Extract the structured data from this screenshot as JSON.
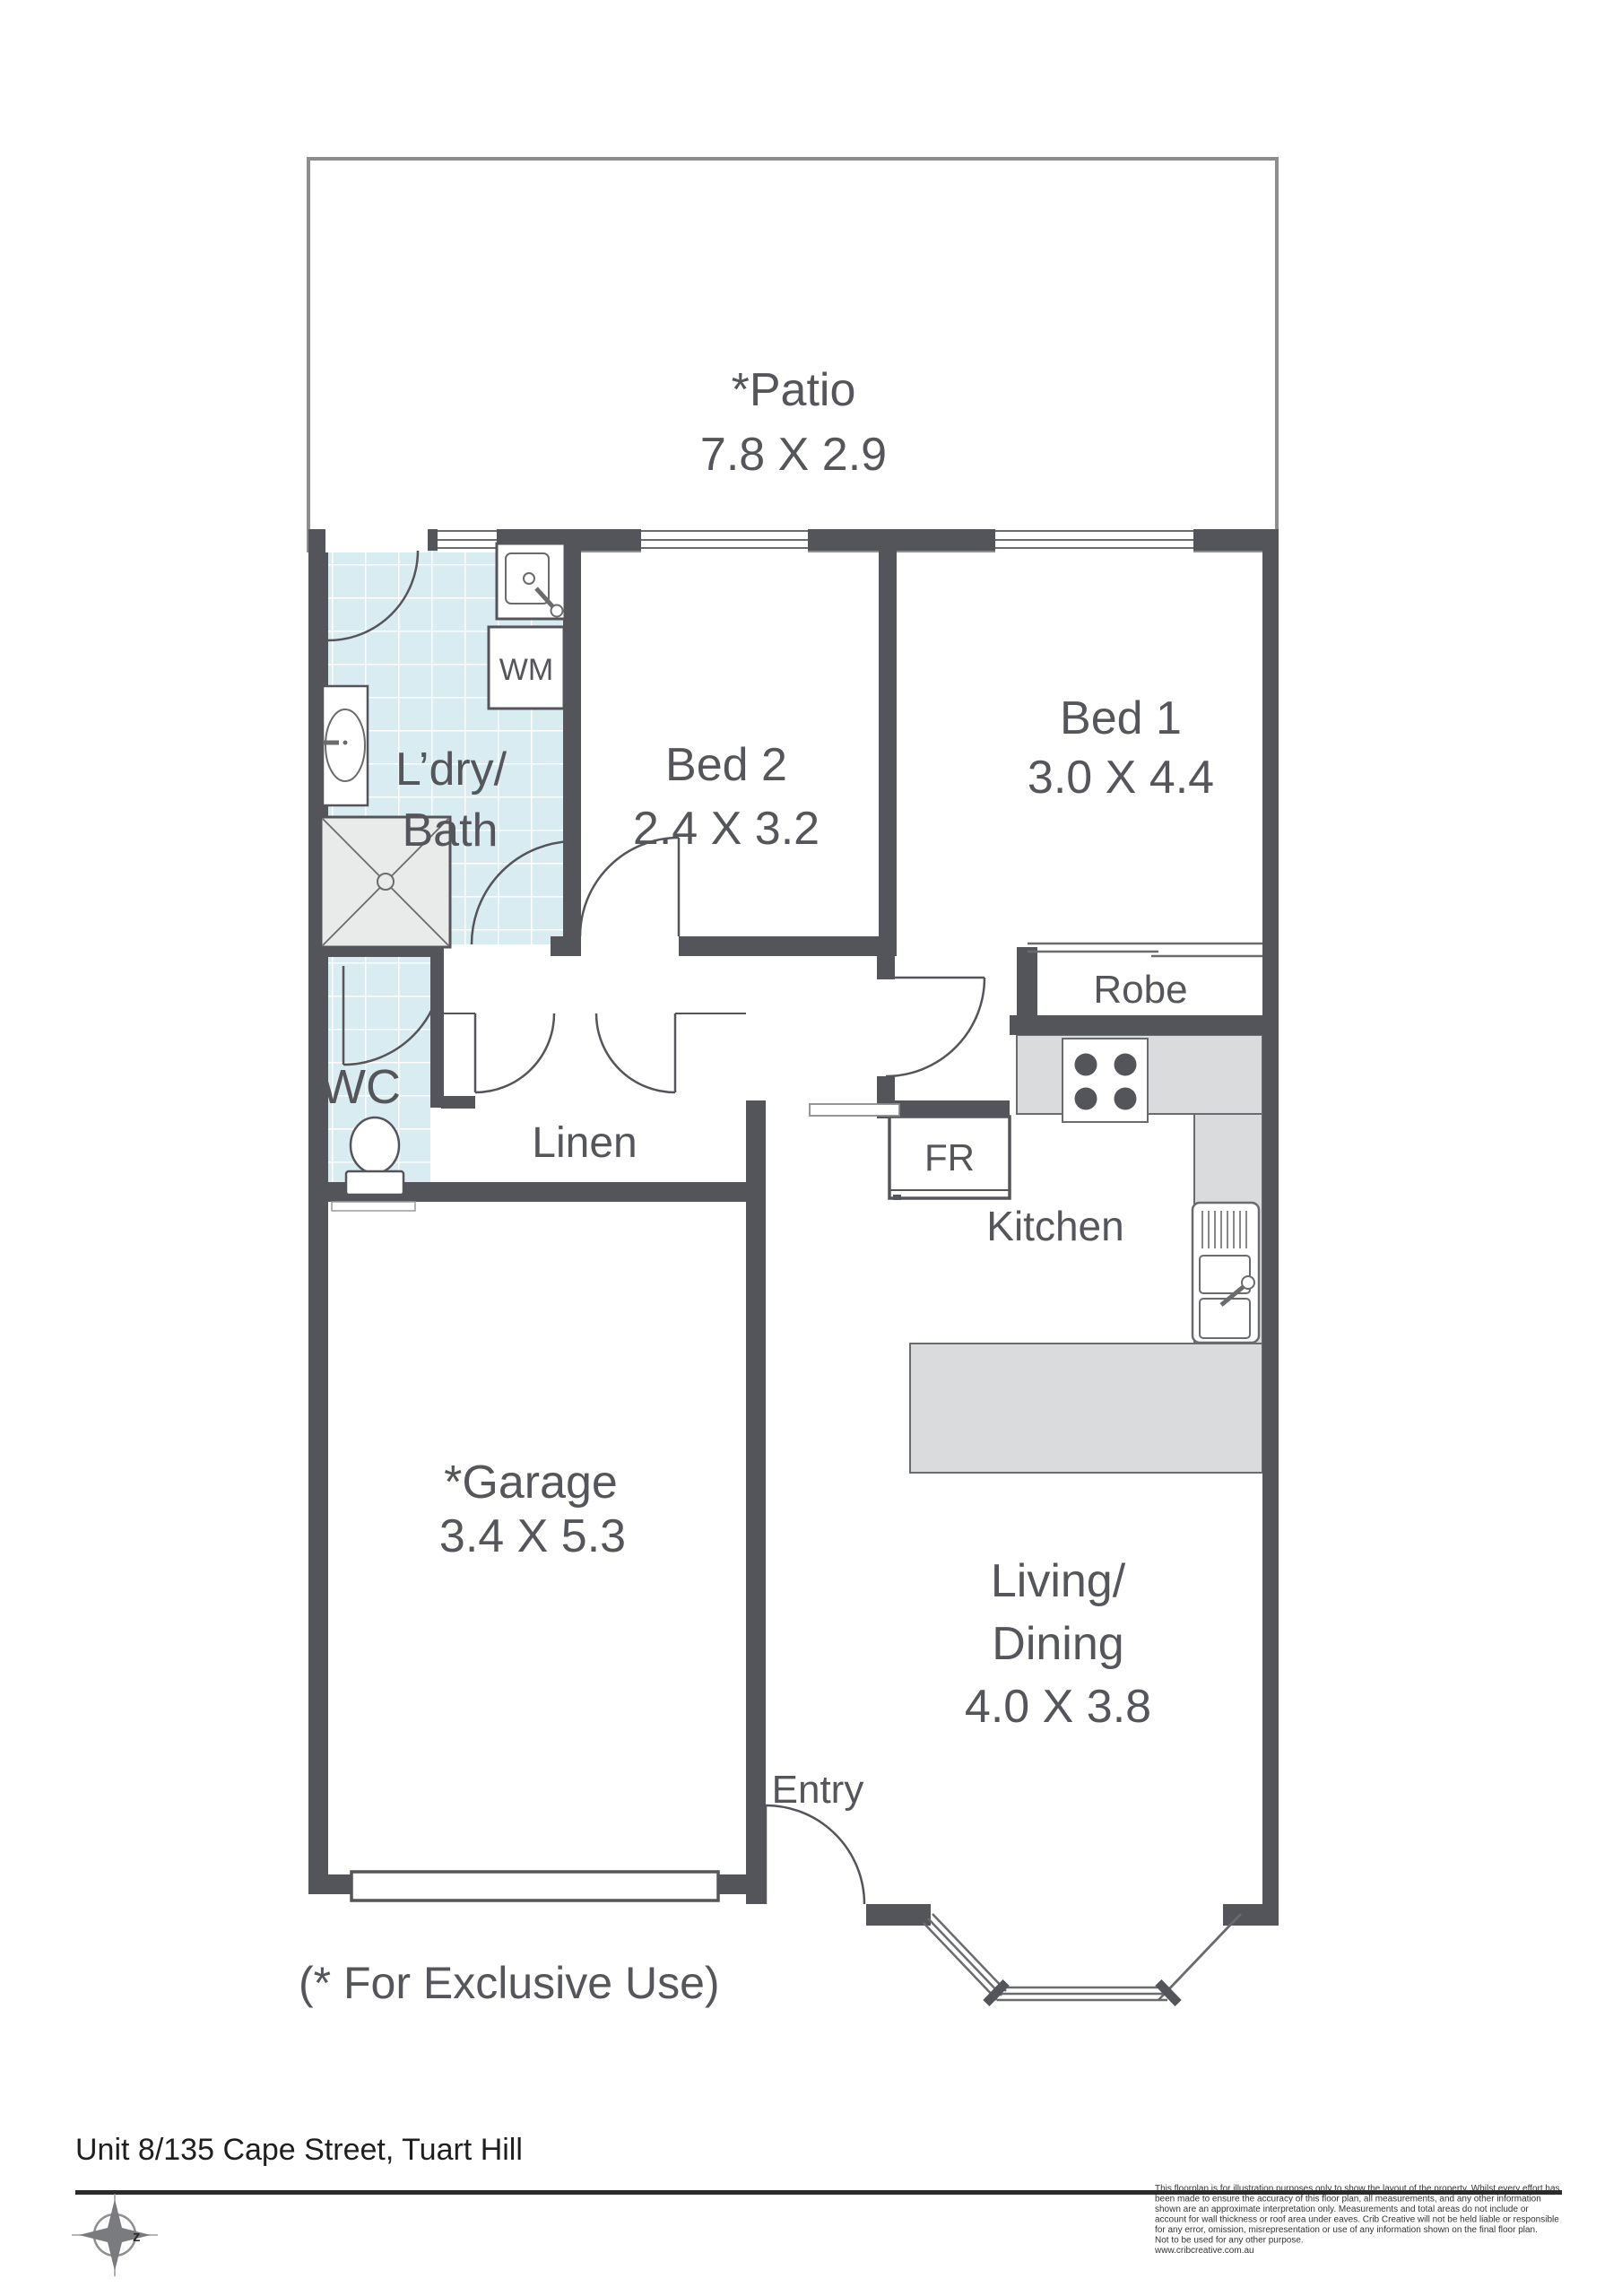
{
  "colors": {
    "wall": "#54555a",
    "label": "#55565b",
    "tile": "#d9ecf1",
    "tile_grid": "#ffffff",
    "counter": "#dadbdc",
    "shower_fill": "#e9eaea",
    "patio_border": "#8d8e90",
    "window_line": "#6a6b6e"
  },
  "rooms": {
    "patio": {
      "name": "*Patio",
      "dims": "7.8 X 2.9"
    },
    "laundry": {
      "line1": "L’dry/",
      "line2": "Bath"
    },
    "bed2": {
      "name": "Bed 2",
      "dims": "2.4 X 3.2"
    },
    "bed1": {
      "name": "Bed 1",
      "dims": "3.0 X 4.4"
    },
    "robe": {
      "name": "Robe"
    },
    "wc": {
      "name": "WC"
    },
    "linen": {
      "name": "Linen"
    },
    "kitchen": {
      "name": "Kitchen"
    },
    "garage": {
      "name": "*Garage",
      "dims": "3.4 X 5.3"
    },
    "living": {
      "line1": "Living/",
      "line2": "Dining",
      "dims": "4.0 X 3.8"
    },
    "entry": {
      "name": "Entry"
    }
  },
  "appliances": {
    "washing_machine": "WM",
    "fridge": "FR"
  },
  "note": "(* For Exclusive Use)",
  "compass": {
    "letter": "z"
  },
  "footer": {
    "address": "Unit 8/135 Cape Street, Tuart Hill",
    "disclaimer": [
      "This floorplan is for illustration purposes only to show the layout of the property. Whilst every effort has",
      "been made to ensure the accuracy of this floor plan, all measurements, and any other information",
      "shown are an approximate interpretation only. Measurements and total areas do not include or",
      "account for wall thickness or roof area under eaves. Crib Creative will not be held liable or responsible",
      "for any error, omission, misrepresentation or use of any information shown on the final floor plan.",
      "Not to be used for any other purpose.",
      "www.cribcreative.com.au"
    ]
  }
}
